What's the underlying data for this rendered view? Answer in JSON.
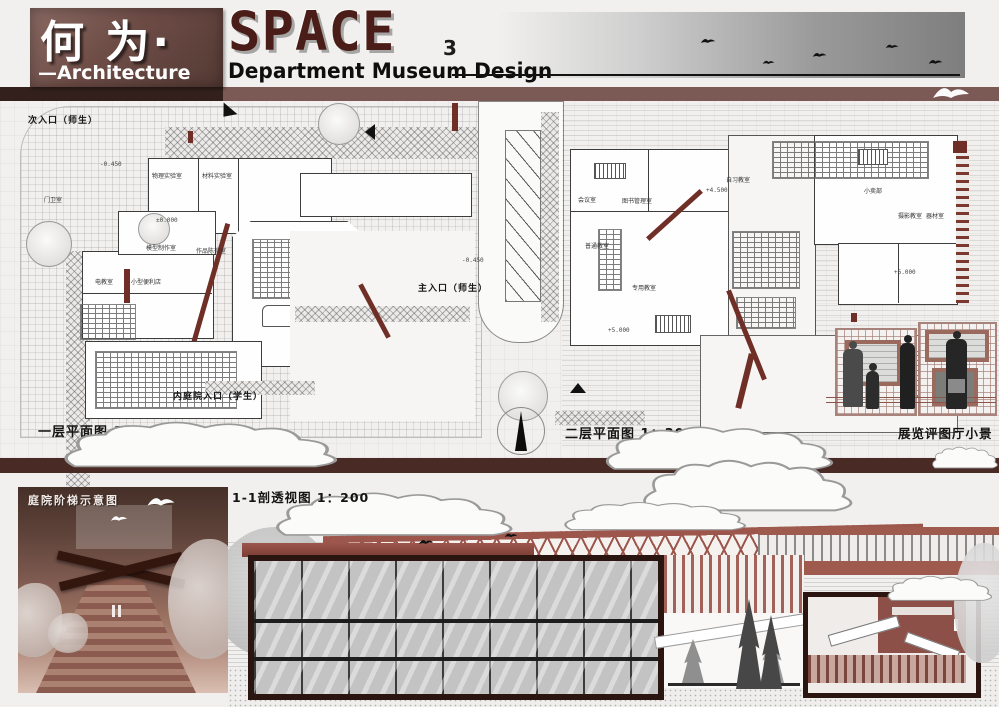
{
  "header": {
    "title_cn": "何 为·",
    "title_en": "SPACE",
    "edition": "3",
    "subtitle_left": "—Architecture",
    "subtitle_right": "Department Museum Design"
  },
  "plans": {
    "plan1": {
      "caption": "一层平面图 1：300",
      "entrance_secondary": "次入口（师生）",
      "entrance_main": "主入口（师生）",
      "entrance_courtyard": "内庭院入口（学生）",
      "levels": {
        "ground": "±0.000",
        "sunken": "-0.450"
      },
      "rooms": [
        "物理实验室",
        "材料实验室",
        "门卫室",
        "模型制作室",
        "电教室",
        "小型便利店",
        "作品陈列室"
      ]
    },
    "plan2": {
      "caption": "二层平面图 1：300",
      "levels": {
        "l1": "+4.500",
        "l2": "+5.000",
        "l3": "+6.000"
      },
      "rooms": [
        "会议室",
        "图书管理室",
        "自习教室",
        "普通教室",
        "专用教室",
        "小卖部",
        "摄影教室",
        "器材室"
      ]
    },
    "vignette": {
      "caption": "展览评图厅小景"
    }
  },
  "bottom": {
    "stair_view": {
      "caption": "庭院阶梯示意图"
    },
    "section_view": {
      "caption": "1-1剖透视图 1：200"
    }
  },
  "colors": {
    "brand_brown": "#6e4c46",
    "title_maroon": "#4a1d18",
    "accent_maroon": "#6f2e26",
    "separator_band": "#4a2a24",
    "dark_poche": "#2a1511"
  }
}
